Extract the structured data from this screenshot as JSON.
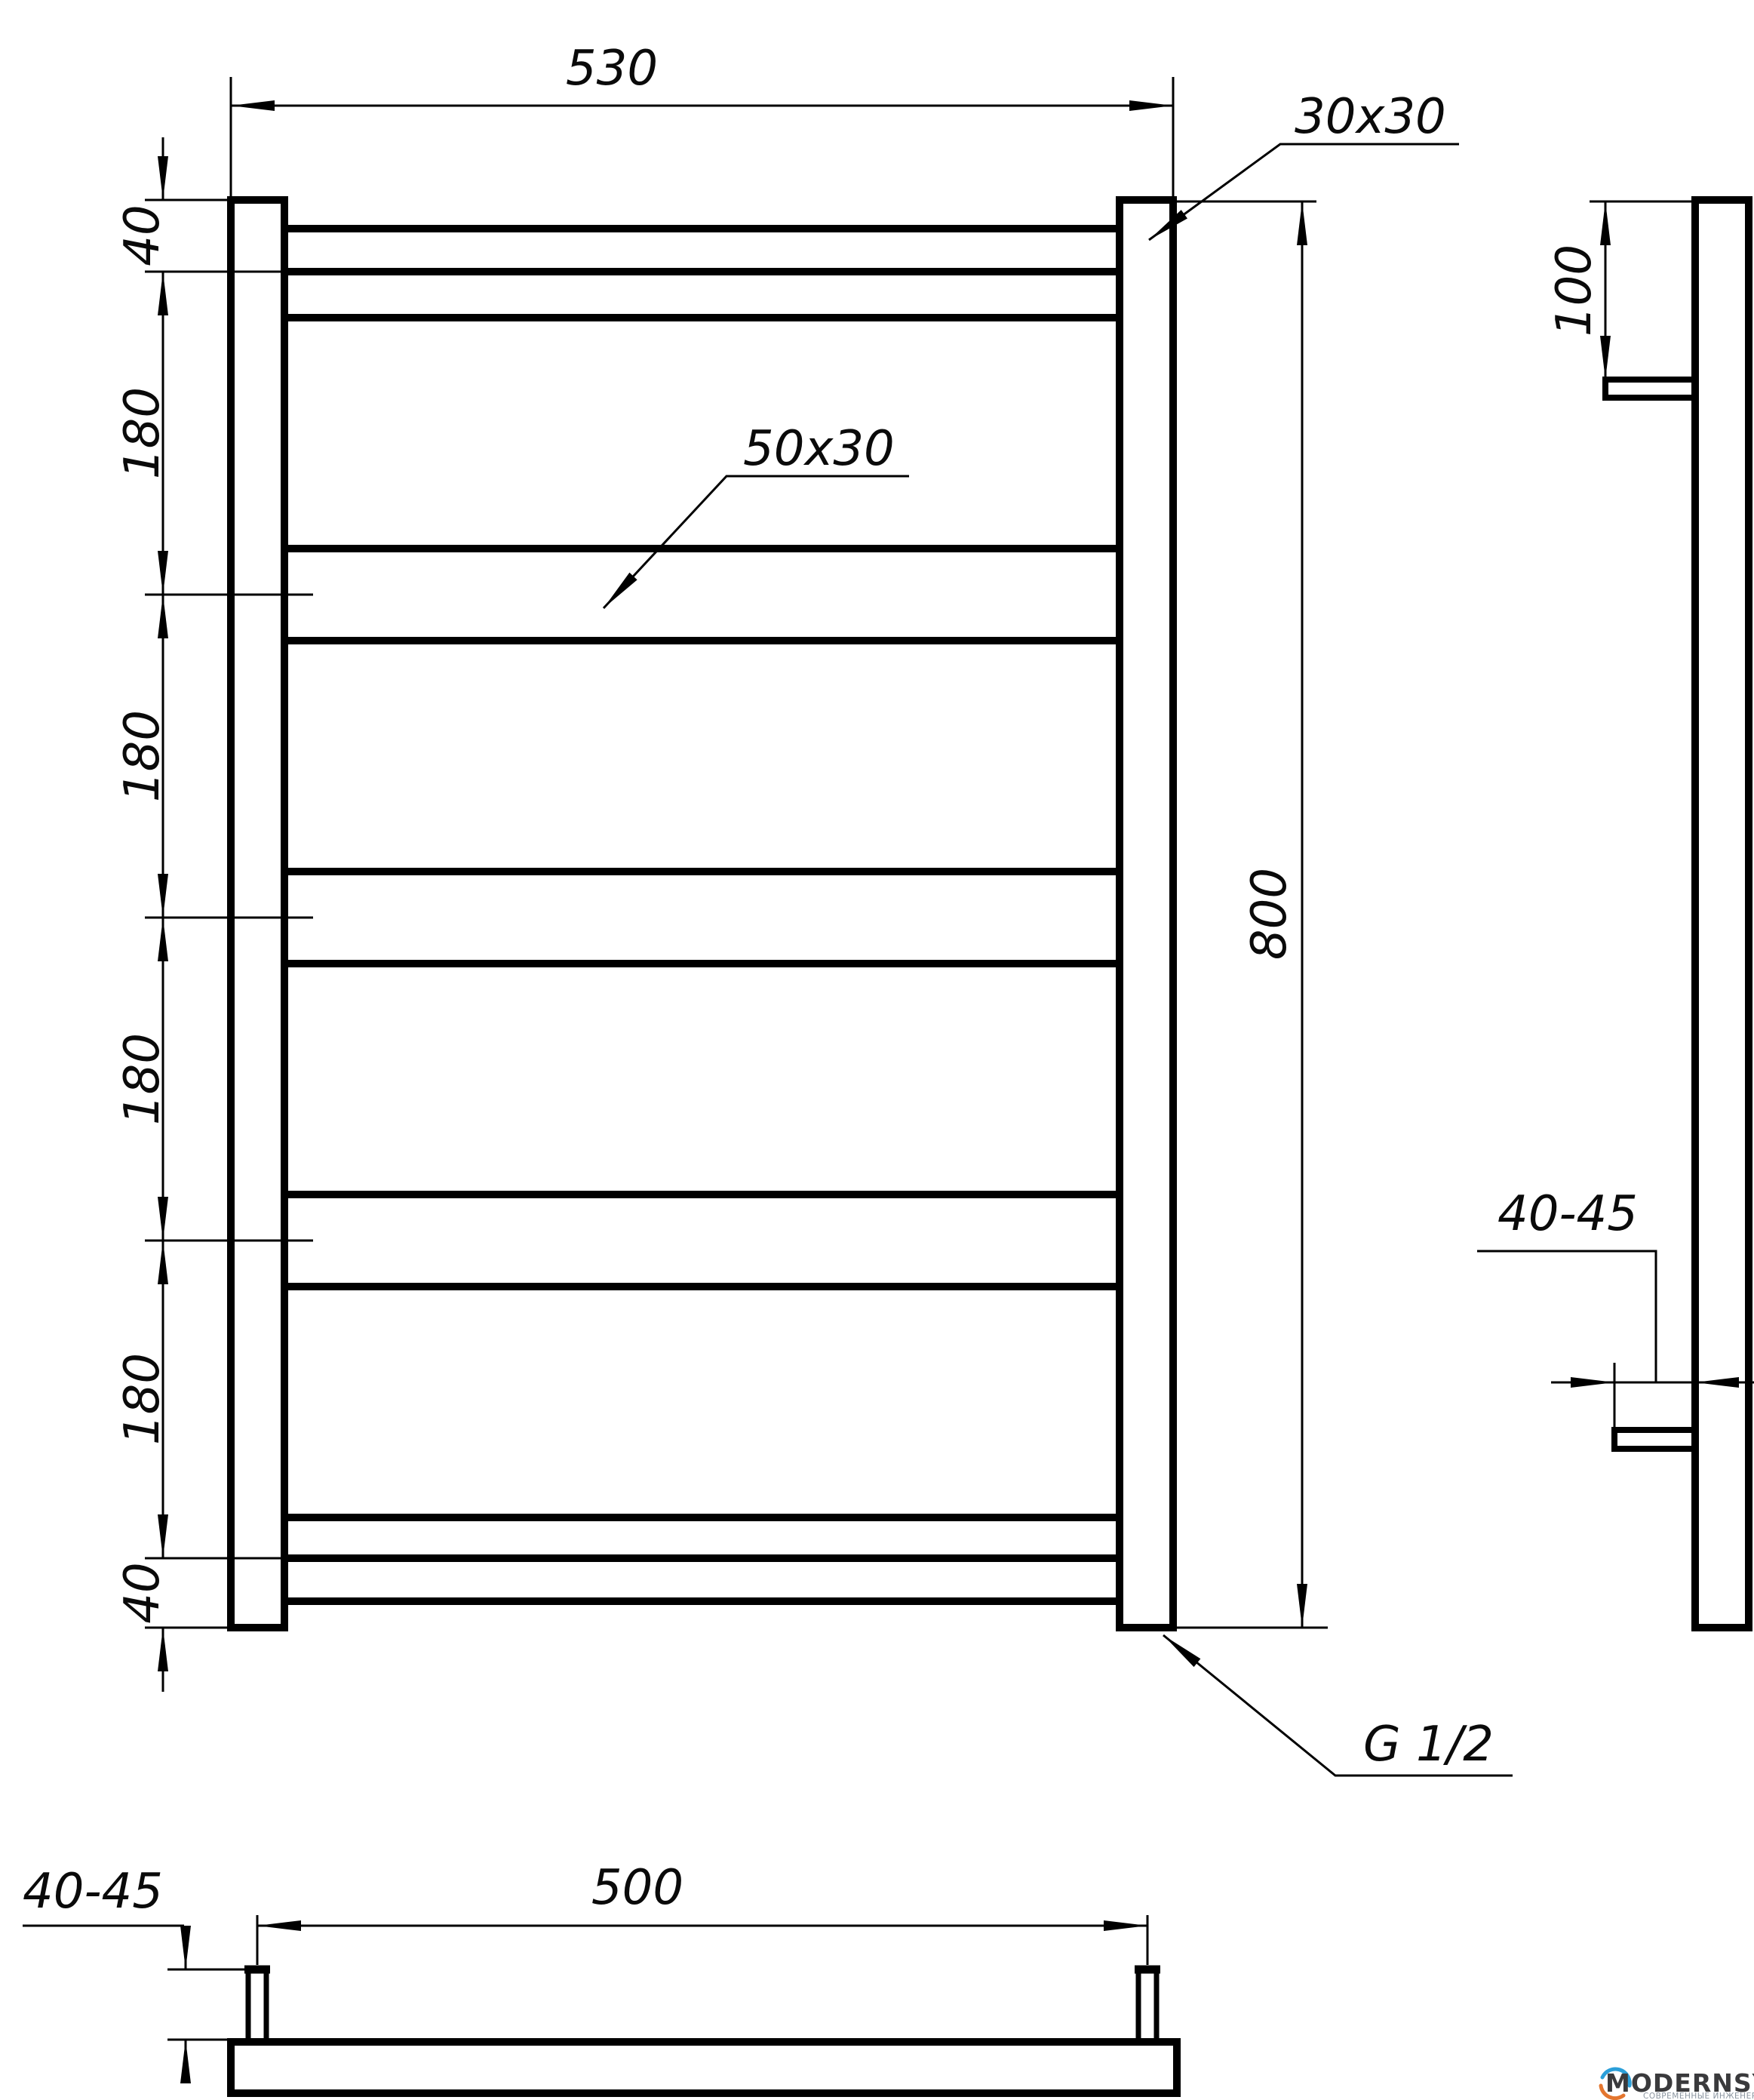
{
  "page": {
    "background": "#ffffff",
    "line_color": "#000000"
  },
  "views": {
    "front": {
      "dim_width_top": "530",
      "dim_height": "800",
      "dim_top_gap": "40",
      "dim_bottom_gap": "40",
      "dim_pitches": [
        "180",
        "180",
        "180",
        "180"
      ],
      "callout_post_profile": "30x30",
      "callout_rung_profile": "50x30",
      "callout_thread": "G 1/2"
    },
    "side": {
      "dim_bracket_offset_top": "100",
      "dim_wall_distance": "40-45"
    },
    "bottom": {
      "dim_bracket_spacing": "500",
      "dim_bracket_height": "40-45"
    }
  },
  "logo": {
    "brand": "MODERNSYS",
    "tagline": "СОВРЕМЕННЫЕ ИНЖЕНЕРНЫЕ СИСТЕМЫ",
    "colors": {
      "brand": "#3a3a3c",
      "tagline": "#8b95a0",
      "arc_top": "#2b9fd9",
      "arc_bottom": "#e4762f"
    }
  }
}
